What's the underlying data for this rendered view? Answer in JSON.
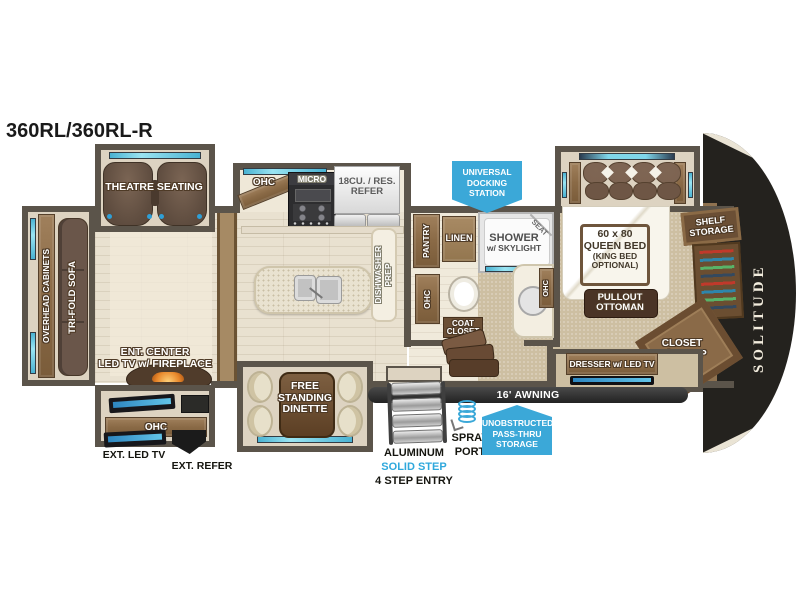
{
  "title": "360RL/360RL-R",
  "brand": {
    "logo": "SOLITUDE"
  },
  "colors": {
    "badge_blue": "#3BA8D8",
    "accent_teal": "#7FD6EA",
    "wall_brown": "#5B544A",
    "step_text_blue": "#2FA8DC"
  },
  "living": {
    "theatre_seating": "THEATRE SEATING",
    "overhead_cabinets": "OVERHEAD CABINETS",
    "tri_fold_sofa": "TRI-FOLD SOFA",
    "ent_center": [
      "ENT. CENTER",
      "LED TV w/ FIREPLACE"
    ],
    "ohc": "OHC",
    "ext_led_tv": "EXT. LED TV",
    "ext_refer": "EXT. REFER"
  },
  "kitchen": {
    "ohc": "OHC",
    "micro": "MICRO",
    "refer": [
      "18CU. / RES.",
      "REFER"
    ],
    "dishwasher_prep": [
      "DISHWASHER",
      "PREP"
    ],
    "dinette": [
      "FREE",
      "STANDING",
      "DINETTE"
    ]
  },
  "bath": {
    "pantry": "PANTRY",
    "linen": "LINEN",
    "shower": [
      "SHOWER",
      "w/ SKYLIGHT"
    ],
    "seat": "SEAT",
    "ohc_left": "OHC",
    "ohc_right": "OHC",
    "coat_closet": [
      "COAT",
      "CLOSET"
    ]
  },
  "bedroom": {
    "bed": [
      "60 x 80",
      "QUEEN BED",
      "(KING BED",
      "OPTIONAL)"
    ],
    "pullout_ottoman": [
      "PULLOUT",
      "OTTOMAN"
    ],
    "shelf_storage": [
      "SHELF",
      "STORAGE"
    ],
    "closet_wd_prep": [
      "CLOSET",
      "W/D PREP"
    ],
    "dresser": "DRESSER w/ LED TV"
  },
  "exterior": {
    "docking_station": [
      "UNIVERSAL",
      "DOCKING",
      "STATION"
    ],
    "awning": "16' AWNING",
    "pass_thru": [
      "UNOBSTRUCTED",
      "PASS-THRU",
      "STORAGE"
    ],
    "spray_port": [
      "SPRAY",
      "PORT"
    ],
    "entry_steps": [
      "ALUMINUM",
      "SOLID STEP",
      "4 STEP ENTRY"
    ]
  }
}
